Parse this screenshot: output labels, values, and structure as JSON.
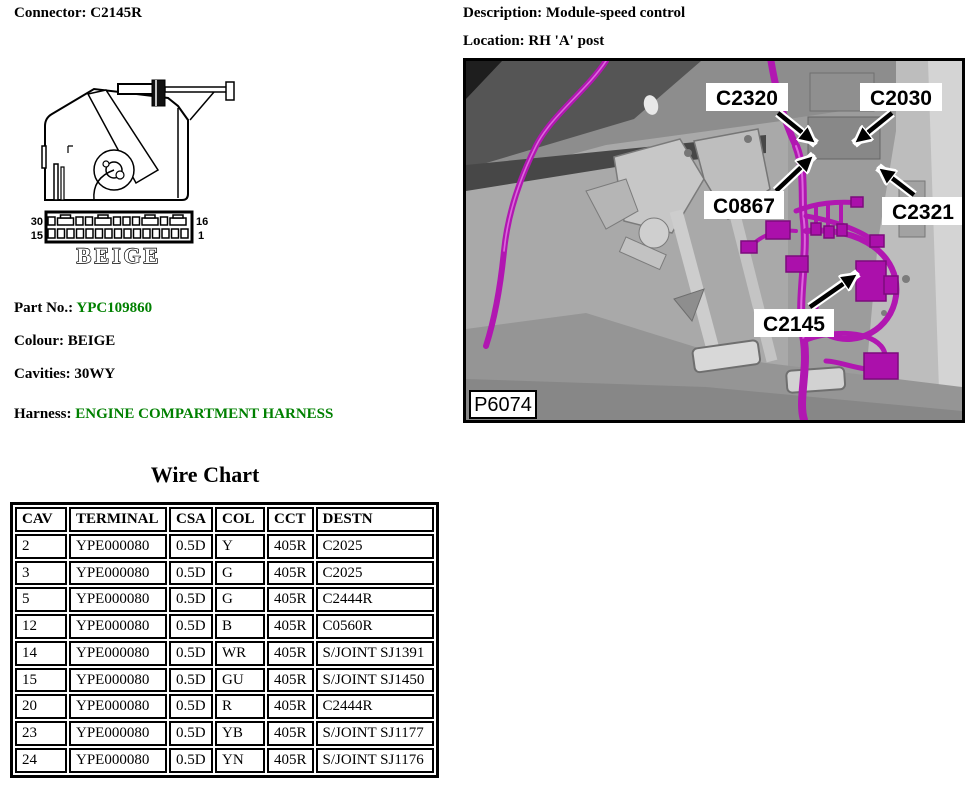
{
  "header": {
    "connector": {
      "label": "Connector:",
      "value": "C2145R"
    },
    "description": {
      "label": "Description:",
      "value": "Module-speed control"
    },
    "location": {
      "label": "Location:",
      "value": "RH 'A' post"
    }
  },
  "details": {
    "part_no": {
      "label": "Part No.:",
      "value": "YPC109860"
    },
    "colour": {
      "label": "Colour:",
      "value": "BEIGE"
    },
    "cavities": {
      "label": "Cavities:",
      "value": "30WY"
    },
    "harness": {
      "label": "Harness:",
      "value": "ENGINE COMPARTMENT HARNESS"
    }
  },
  "connector_drawing": {
    "pin_top_left": "30",
    "pin_top_right": "16",
    "pin_bottom_left": "15",
    "pin_bottom_right": "1",
    "colour_text": "BEIGE"
  },
  "photo": {
    "figure_id": "P6074",
    "callouts": [
      "C2320",
      "C2030",
      "C0867",
      "C2321",
      "C2145"
    ]
  },
  "wire_chart": {
    "title": "Wire Chart",
    "columns": [
      "CAV",
      "TERMINAL",
      "CSA",
      "COL",
      "CCT",
      "DESTN"
    ],
    "rows": [
      [
        "2",
        "YPE000080",
        "0.5D",
        "Y",
        "405R",
        "C2025"
      ],
      [
        "3",
        "YPE000080",
        "0.5D",
        "G",
        "405R",
        "C2025"
      ],
      [
        "5",
        "YPE000080",
        "0.5D",
        "G",
        "405R",
        "C2444R"
      ],
      [
        "12",
        "YPE000080",
        "0.5D",
        "B",
        "405R",
        "C0560R"
      ],
      [
        "14",
        "YPE000080",
        "0.5D",
        "WR",
        "405R",
        "S/JOINT SJ1391"
      ],
      [
        "15",
        "YPE000080",
        "0.5D",
        "GU",
        "405R",
        "S/JOINT SJ1450"
      ],
      [
        "20",
        "YPE000080",
        "0.5D",
        "R",
        "405R",
        "C2444R"
      ],
      [
        "23",
        "YPE000080",
        "0.5D",
        "YB",
        "405R",
        "S/JOINT SJ1177"
      ],
      [
        "24",
        "YPE000080",
        "0.5D",
        "YN",
        "405R",
        "S/JOINT SJ1176"
      ]
    ]
  },
  "colors": {
    "label_green": "#008000",
    "harness_magenta": "#b117b1",
    "connector_block": "#ab10ab"
  }
}
